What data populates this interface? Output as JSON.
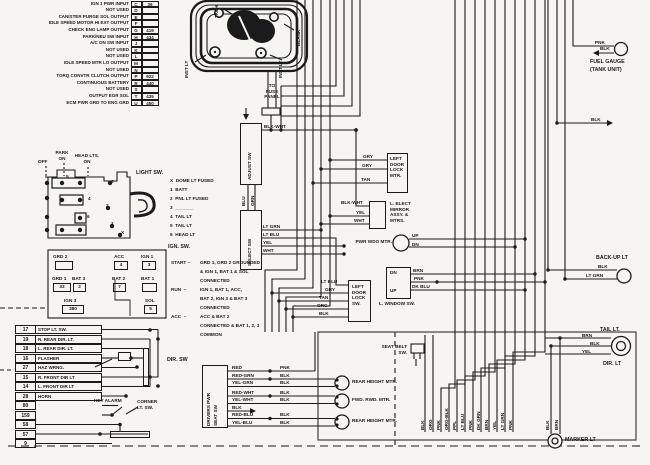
{
  "ecm": {
    "rows": [
      {
        "label": "IGN 1 PWR INPUT",
        "pin": "C",
        "wire": "39"
      },
      {
        "label": "NOT USED",
        "pin": "D",
        "wire": ""
      },
      {
        "label": "CANISTER PURGE SOL OUTPUT",
        "pin": "E",
        "wire": ""
      },
      {
        "label": "IDLE SPEED MOTOR HI EXT OUTPUT",
        "pin": "F",
        "wire": ""
      },
      {
        "label": "CHECK ENG LAMP OUTPUT",
        "pin": "G",
        "wire": "419"
      },
      {
        "label": "PARK/NEU SW INPUT",
        "pin": "H",
        "wire": "434"
      },
      {
        "label": "A/C ON SW INPUT",
        "pin": "J",
        "wire": ""
      },
      {
        "label": "NOT USED",
        "pin": "K",
        "wire": ""
      },
      {
        "label": "NOT USED",
        "pin": "L",
        "wire": ""
      },
      {
        "label": "IDLE SPEED MTR LO OUTPUT",
        "pin": "M",
        "wire": ""
      },
      {
        "label": "NOT USED",
        "pin": "N",
        "wire": ""
      },
      {
        "label": "TORQ CONVTR CLUTCH OUTPUT",
        "pin": "P",
        "wire": "922"
      },
      {
        "label": "CONTINUOUS BATTERY",
        "pin": "R",
        "wire": "440"
      },
      {
        "label": "NOT USED",
        "pin": "S",
        "wire": ""
      },
      {
        "label": "OUTPUT EGR SOL",
        "pin": "T",
        "wire": "435"
      },
      {
        "label": "ECM PWR GRD TO ENG GRD",
        "pin": "U",
        "wire": "450"
      }
    ]
  },
  "cluster": {
    "tach": "TACH",
    "blank": "BLANK",
    "inst_lt_left": "INST LT",
    "inst_lt_right": "INST LT"
  },
  "fuse_panel": {
    "label": "TO\nFUSE\nPANEL"
  },
  "light_sw": {
    "title": "LIGHT SW.",
    "off": "OFF",
    "park": "PARK\nON",
    "head": "HEAD LTS.\nON",
    "legend": [
      "X  DOME LT FUSED",
      "1  BATT",
      "2  PNL LT FUSED",
      "3  _______",
      "4  TAIL LT",
      "5  TAIL LT",
      "6  HEAD LT"
    ],
    "contacts": [
      "5",
      "4",
      "6",
      "3",
      "2",
      "1",
      "X"
    ]
  },
  "ignition": {
    "title": "IGN. SW.",
    "terminals": {
      "grd2": {
        "n": "GRD 2",
        "w": ""
      },
      "acc": {
        "n": "ACC",
        "w": "4"
      },
      "ign1": {
        "n": "IGN 1",
        "w": "3"
      },
      "grd1": {
        "n": "GRD 1",
        "w": "33"
      },
      "bat3": {
        "n": "BAT 3",
        "w": "2"
      },
      "bat2": {
        "n": "BAT 2",
        "w": "7"
      },
      "bat1": {
        "n": "BAT 1",
        "w": ""
      },
      "ign3": {
        "n": "IGN 3",
        "w": "380"
      },
      "sol": {
        "n": "SOL",
        "w": "5"
      }
    },
    "notes": [
      {
        "mode": "START –",
        "text": "GRD 1, GRD 2 GROUNDED\n& IGN 1, BAT 1 & SOL\nCONNECTED"
      },
      {
        "mode": "RUN  –",
        "text": "IGN 1, BAT 1, ACC,\nBAT 2, IGN 3 & BAT 3\nCONNECTED"
      },
      {
        "mode": "ACC  –",
        "text": "ACC & BAT 2\nCONNECTED & BAT 1, 2, 3\nCOMMON"
      }
    ]
  },
  "dir_sw": {
    "rows": [
      {
        "num": "17",
        "label": "STOP LT. SW."
      },
      {
        "num": "19",
        "label": "R. REAR DIR. LT."
      },
      {
        "num": "18",
        "label": "L. REAR DIR. LT."
      },
      {
        "num": "16",
        "label": "FLASHER"
      },
      {
        "num": "27",
        "label": "HAZ WRNG."
      },
      {
        "num": "15",
        "label": "R. FRONT DIR LT"
      },
      {
        "num": "14",
        "label": "L. FRONT DIR LT"
      },
      {
        "num": "28",
        "label": "HORN"
      },
      {
        "num": "80",
        "label": ""
      },
      {
        "num": "159",
        "label": ""
      }
    ],
    "corner_rows": [
      "58",
      "57",
      "9"
    ],
    "dir_label": "DIR. SW",
    "key_alarm": "KEY ALARM",
    "corner_label": "CORNER\nLT. SW."
  },
  "switches": {
    "adjust": "ADJUST SW",
    "select": "SELECT SW"
  },
  "wires": {
    "blk_wht_adj": "BLK-WHT",
    "blu": "BLU",
    "grn": "GRN",
    "gry1": "GRY",
    "gry2": "GRY",
    "tan1": "TAN",
    "blk_wht_mir": "BLK-WHT",
    "yel_mir": "YEL",
    "wht_mir": "WHT",
    "lt_grn_sel": "LT GRN",
    "lt_blu_sel": "LT BLU",
    "yel_sel": "YEL",
    "wht_sel": "WHT",
    "lt_blu_dl": "LT BLU",
    "gry_dl": "GRY",
    "tan_dl": "TAN",
    "org_dl": "ORG",
    "blk_dl": "BLK",
    "brn_win": "BRN",
    "pnk_win": "PNK",
    "dkblu_win": "DK BLU",
    "dn_win": "DN",
    "up_win": "UP",
    "up_mtr": "UP",
    "dn_mtr": "DN"
  },
  "components": {
    "dlmtr_text": "LEFT\nDOOR\nLOCK\nMTR.",
    "mirror_text": "L. ELECT\nMIRROR\nASSY. &\nMTRS.",
    "dlsw_text": "LEFT\nDOOR\nLOCK\nSW.",
    "window_label": "L. WINDOW SW.",
    "pwr_wdo_label": "PWR WDO MTR.",
    "seat_belt_label": "SEAT BELT\nSW."
  },
  "seat": {
    "title": "DRIVERS PWR\nSEAT SW",
    "rows": [
      {
        "a": "RED",
        "b": "PNK"
      },
      {
        "a": "RED-GRN",
        "b": "BLK"
      },
      {
        "a": "YEL-GRN",
        "b": "BLK"
      },
      {
        "a": "RED-WHT",
        "b": "BLK"
      },
      {
        "a": "YEL-WHT",
        "b": "BLK"
      },
      {
        "a": "BLK",
        "b": ""
      },
      {
        "a": "RED-BLU",
        "b": "BLK"
      },
      {
        "a": "YEL-BLU",
        "b": "BLK"
      }
    ],
    "motors": [
      "REAR HEIGHT MTR.",
      "FWD. RWD. MTR.",
      "REAR HEIGHT MTR."
    ]
  },
  "right": {
    "fuel": {
      "pnk": "PNK",
      "blk": "BLK",
      "t1": "FUEL GAUGE",
      "t2": "(TANK UNIT)",
      "gnd": "BLK"
    },
    "backup": {
      "title": "BACK-UP LT",
      "blk": "BLK",
      "ltgrn": "LT GRN"
    },
    "tail": {
      "title": "TAIL LT.",
      "brn": "BRN",
      "blk": "BLK",
      "yel": "YEL",
      "dir": "DIR. LT"
    },
    "marker": {
      "title": "MARKER LT",
      "blk": "BLK",
      "brn": "BRN"
    }
  },
  "bottom_bus": {
    "labels": [
      "BLK",
      "ORG",
      "PNK",
      "ORG-BLK",
      "PPL",
      "LT BLU",
      "PNK",
      "DK GRN",
      "BRN",
      "YEL",
      "LT GRN",
      "PNK"
    ]
  }
}
